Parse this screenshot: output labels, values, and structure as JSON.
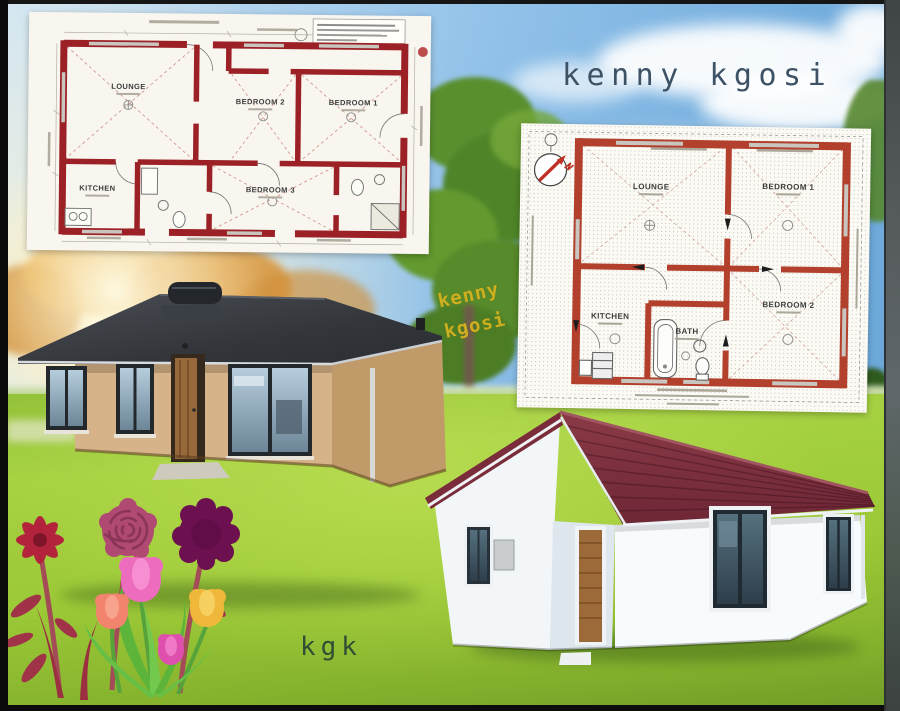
{
  "text": {
    "title": "kenny kgosi",
    "watermark_line1": "kenny",
    "watermark_line2": "kgosi",
    "signature": "kgk"
  },
  "floorplan_left": {
    "rooms": {
      "lounge": "LOUNGE",
      "bedroom2": "BEDROOM 2",
      "bedroom1": "BEDROOM 1",
      "kitchen": "KITCHEN",
      "bedroom3": "BEDROOM 3"
    }
  },
  "floorplan_right": {
    "rooms": {
      "lounge": "LOUNGE",
      "bedroom1": "BEDROOM 1",
      "kitchen": "KITCHEN",
      "bath": "BATH",
      "bedroom2": "BEDROOM 2"
    }
  },
  "palette": {
    "plan_wall_left": "#9c2126",
    "plan_wall_right": "#b2402c",
    "title_text": "#3e5266",
    "watermark_text": "#d9b31f",
    "signature_text": "#2f4f35",
    "roof_dark": "#34373c",
    "roof_maroon": "#7c3040",
    "wall_tan": "#d6b388",
    "wall_white": "#f4f8fb",
    "grass_green": "#9cc937",
    "sky_blue": "#74aede"
  }
}
